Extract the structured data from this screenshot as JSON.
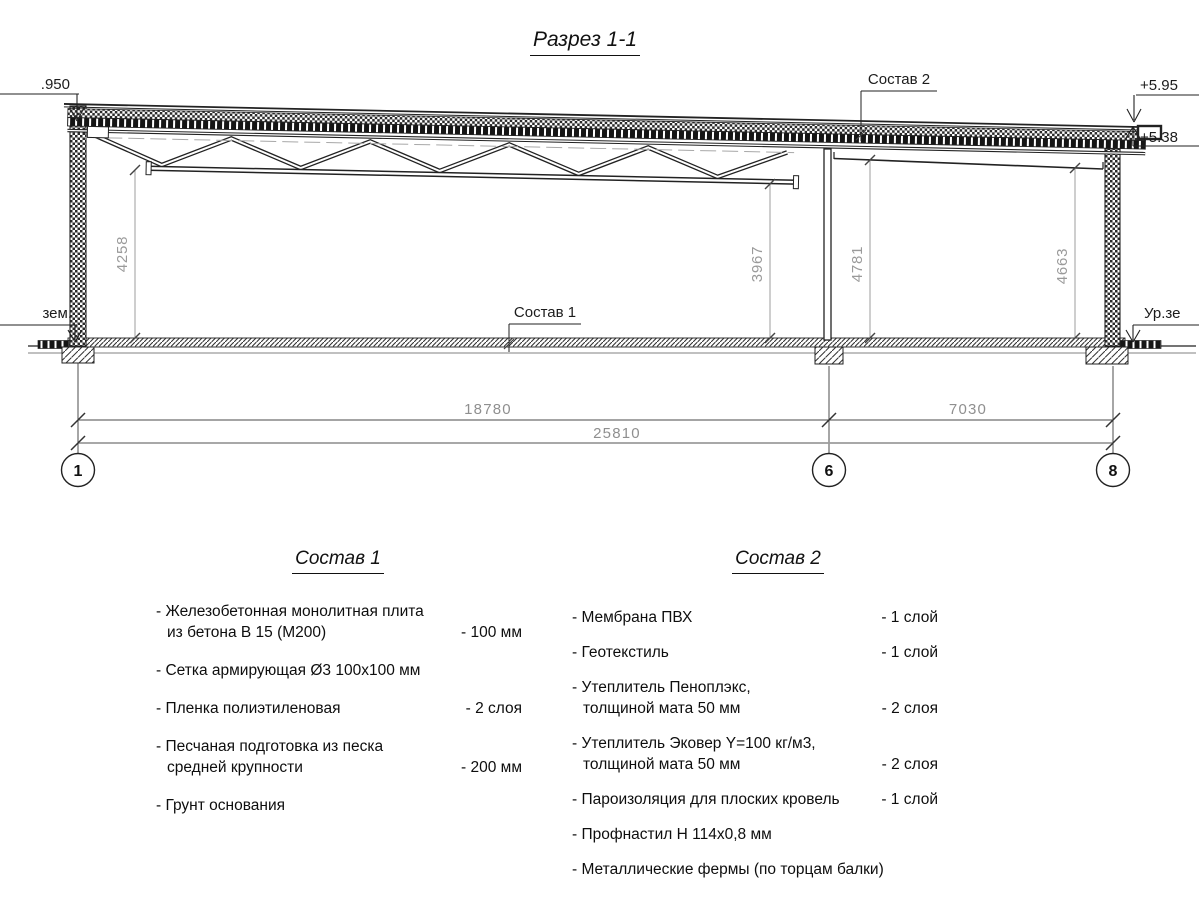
{
  "title": "Разрез 1-1",
  "marks": {
    "elev_left": ".950",
    "elev_right_top": "+5.95",
    "elev_right_mid": "+5.38",
    "ground_left": "зем.",
    "ground_right": "Ур.зе",
    "roof_label": "Состав 2",
    "floor_label": "Состав 1"
  },
  "dims": {
    "v1": "4258",
    "v2": "3967",
    "v3": "4781",
    "v4": "4663",
    "h1": "18780",
    "h2": "7030",
    "h3": "25810"
  },
  "axes": {
    "a1": "1",
    "a2": "6",
    "a3": "8"
  },
  "sostav1": {
    "heading": "Состав 1",
    "items": [
      {
        "l1": "- Железобетонная  монолитная плита",
        "l2": "из бетона В 15 (М200)",
        "val": "- 100 мм"
      },
      {
        "l1": "- Сетка армирующая Ø3 100х100 мм",
        "l2": "",
        "val": ""
      },
      {
        "l1": "- Пленка полиэтиленовая",
        "l2": "",
        "val": "-  2 слоя"
      },
      {
        "l1": "- Песчаная подготовка из песка",
        "l2": "средней крупности",
        "val": "- 200 мм"
      },
      {
        "l1": "- Грунт основания",
        "l2": "",
        "val": ""
      }
    ]
  },
  "sostav2": {
    "heading": "Состав 2",
    "items": [
      {
        "l1": "- Мембрана ПВХ",
        "l2": "",
        "val": "- 1 слой"
      },
      {
        "l1": "- Геотекстиль",
        "l2": "",
        "val": "- 1 слой"
      },
      {
        "l1": "- Утеплитель Пеноплэкс,",
        "l2": "толщиной мата 50 мм",
        "val": "- 2 слоя"
      },
      {
        "l1": "- Утеплитель Эковер Y=100 кг/м3,",
        "l2": "толщиной мата 50 мм",
        "val": "- 2 слоя"
      },
      {
        "l1": "- Пароизоляция для плоских кровель",
        "l2": "",
        "val": "- 1 слой"
      },
      {
        "l1": "- Профнастил Н 114х0,8 мм",
        "l2": "",
        "val": ""
      },
      {
        "l1": "- Металлические фермы (по торцам балки)",
        "l2": "",
        "val": ""
      }
    ]
  },
  "colors": {
    "line": "#222222",
    "dim_gray": "#9a9a9a",
    "text": "#111111"
  }
}
